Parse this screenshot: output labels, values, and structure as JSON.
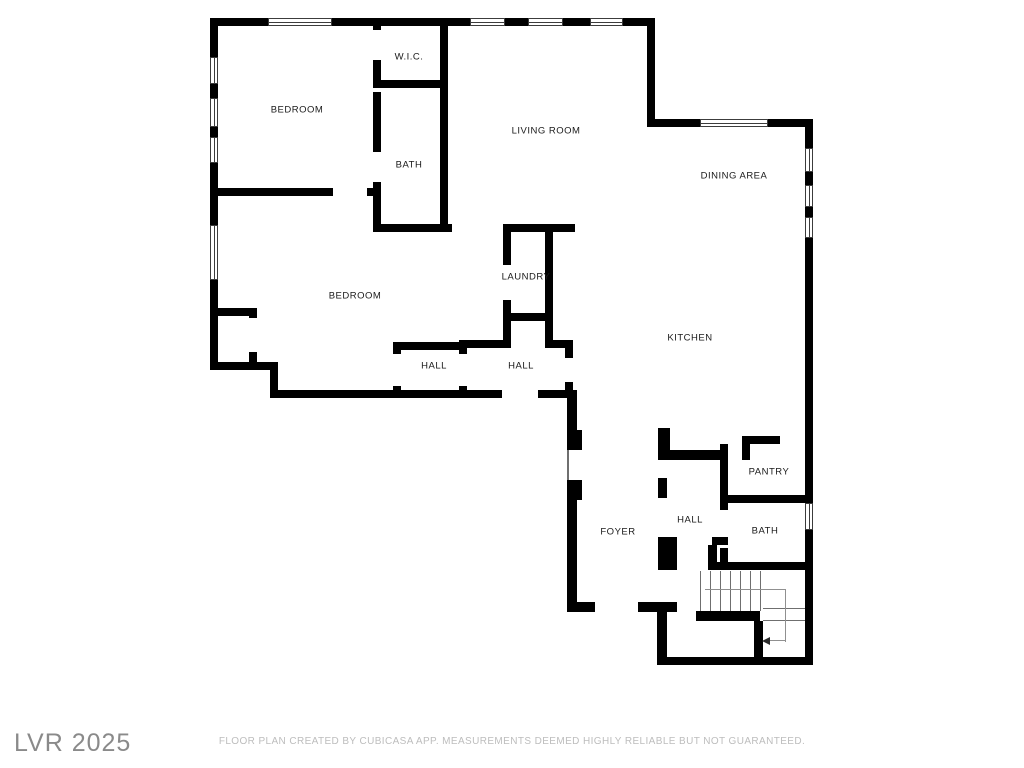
{
  "watermark": {
    "text": "LVR 2025",
    "color": "#8a8a8a"
  },
  "disclaimer": {
    "text": "FLOOR PLAN CREATED BY CUBICASA APP. MEASUREMENTS DEEMED HIGHLY RELIABLE BUT NOT GUARANTEED.",
    "color": "#bdbdbd"
  },
  "floorplan": {
    "wall_color": "#000000",
    "label_color": "#1a1a1a",
    "rooms": [
      {
        "id": "wic",
        "label": "W.I.C.",
        "x": 409,
        "y": 57
      },
      {
        "id": "bedroom-1",
        "label": "BEDROOM",
        "x": 297,
        "y": 110
      },
      {
        "id": "bath-upper",
        "label": "BATH",
        "x": 409,
        "y": 165
      },
      {
        "id": "living-room",
        "label": "LIVING ROOM",
        "x": 546,
        "y": 131
      },
      {
        "id": "dining-area",
        "label": "DINING AREA",
        "x": 734,
        "y": 176
      },
      {
        "id": "bedroom-2",
        "label": "BEDROOM",
        "x": 355,
        "y": 296
      },
      {
        "id": "laundry",
        "label": "LAUNDRY",
        "x": 526,
        "y": 277
      },
      {
        "id": "hall-1",
        "label": "HALL",
        "x": 434,
        "y": 366
      },
      {
        "id": "hall-2",
        "label": "HALL",
        "x": 521,
        "y": 366
      },
      {
        "id": "kitchen",
        "label": "KITCHEN",
        "x": 690,
        "y": 338
      },
      {
        "id": "pantry",
        "label": "PANTRY",
        "x": 769,
        "y": 472
      },
      {
        "id": "hall-3",
        "label": "HALL",
        "x": 690,
        "y": 520
      },
      {
        "id": "foyer",
        "label": "FOYER",
        "x": 618,
        "y": 532
      },
      {
        "id": "bath-lower",
        "label": "BATH",
        "x": 765,
        "y": 531
      }
    ],
    "walls": [
      [
        210,
        18,
        58,
        8
      ],
      [
        332,
        18,
        138,
        8
      ],
      [
        505,
        18,
        23,
        8
      ],
      [
        563,
        18,
        27,
        8
      ],
      [
        623,
        18,
        32,
        8
      ],
      [
        210,
        18,
        8,
        39
      ],
      [
        210,
        84,
        8,
        14
      ],
      [
        210,
        127,
        8,
        10
      ],
      [
        210,
        163,
        8,
        62
      ],
      [
        210,
        280,
        8,
        90
      ],
      [
        647,
        18,
        8,
        109
      ],
      [
        647,
        119,
        53,
        8
      ],
      [
        768,
        119,
        45,
        8
      ],
      [
        805,
        119,
        8,
        29
      ],
      [
        805,
        172,
        8,
        13
      ],
      [
        805,
        207,
        8,
        10
      ],
      [
        805,
        238,
        8,
        265
      ],
      [
        805,
        530,
        8,
        135
      ],
      [
        373,
        18,
        8,
        12
      ],
      [
        373,
        60,
        8,
        28
      ],
      [
        373,
        80,
        75,
        8
      ],
      [
        440,
        18,
        8,
        214
      ],
      [
        373,
        92,
        8,
        60
      ],
      [
        373,
        182,
        8,
        48
      ],
      [
        373,
        224,
        79,
        8
      ],
      [
        503,
        224,
        72,
        8
      ],
      [
        210,
        188,
        123,
        8
      ],
      [
        367,
        188,
        14,
        8
      ],
      [
        210,
        308,
        47,
        8
      ],
      [
        249,
        308,
        8,
        10
      ],
      [
        249,
        352,
        8,
        18
      ],
      [
        210,
        362,
        68,
        8
      ],
      [
        270,
        362,
        8,
        36
      ],
      [
        278,
        390,
        224,
        8
      ],
      [
        538,
        390,
        39,
        8
      ],
      [
        393,
        342,
        70,
        8
      ],
      [
        393,
        342,
        8,
        12
      ],
      [
        393,
        386,
        8,
        12
      ],
      [
        459,
        342,
        8,
        12
      ],
      [
        459,
        386,
        8,
        12
      ],
      [
        459,
        340,
        52,
        8
      ],
      [
        545,
        340,
        28,
        8
      ],
      [
        503,
        232,
        8,
        33
      ],
      [
        503,
        300,
        8,
        48
      ],
      [
        545,
        232,
        8,
        116
      ],
      [
        511,
        313,
        34,
        8
      ],
      [
        565,
        340,
        8,
        18
      ],
      [
        565,
        382,
        8,
        16
      ],
      [
        567,
        398,
        10,
        52
      ],
      [
        567,
        480,
        10,
        122
      ],
      [
        567,
        430,
        15,
        20
      ],
      [
        567,
        480,
        15,
        20
      ],
      [
        567,
        602,
        28,
        10
      ],
      [
        638,
        602,
        39,
        10
      ],
      [
        657,
        612,
        10,
        53
      ],
      [
        657,
        657,
        156,
        8
      ],
      [
        658,
        428,
        12,
        32
      ],
      [
        665,
        450,
        63,
        10
      ],
      [
        658,
        478,
        9,
        20
      ],
      [
        742,
        436,
        8,
        24
      ],
      [
        742,
        436,
        38,
        8
      ],
      [
        720,
        495,
        93,
        8
      ],
      [
        720,
        444,
        8,
        66
      ],
      [
        720,
        548,
        8,
        22
      ],
      [
        658,
        537,
        19,
        33
      ],
      [
        712,
        537,
        16,
        8
      ],
      [
        708,
        545,
        9,
        25
      ],
      [
        708,
        562,
        105,
        8
      ],
      [
        696,
        611,
        64,
        10
      ],
      [
        754,
        621,
        9,
        42
      ]
    ],
    "windows": [
      [
        268,
        18,
        64,
        8
      ],
      [
        470,
        18,
        35,
        8
      ],
      [
        528,
        18,
        35,
        8
      ],
      [
        590,
        18,
        33,
        8
      ],
      [
        700,
        119,
        68,
        8
      ],
      [
        210,
        57,
        8,
        27
      ],
      [
        210,
        98,
        8,
        29
      ],
      [
        210,
        137,
        8,
        26
      ],
      [
        210,
        225,
        8,
        55
      ],
      [
        805,
        148,
        8,
        24
      ],
      [
        805,
        185,
        8,
        22
      ],
      [
        805,
        217,
        8,
        21
      ],
      [
        805,
        503,
        8,
        27
      ]
    ],
    "thin_lines": [
      [
        567,
        450,
        2,
        30
      ],
      [
        700,
        571,
        1,
        40
      ],
      [
        710,
        571,
        1,
        40
      ],
      [
        720,
        571,
        1,
        40
      ],
      [
        730,
        571,
        1,
        40
      ],
      [
        740,
        571,
        1,
        40
      ],
      [
        750,
        571,
        1,
        40
      ],
      [
        760,
        571,
        1,
        40
      ],
      [
        763,
        608,
        42,
        1
      ],
      [
        763,
        620,
        42,
        1
      ]
    ],
    "guide_lines": [
      [
        705,
        589,
        81,
        1
      ],
      [
        785,
        589,
        1,
        53
      ],
      [
        770,
        640,
        16,
        1
      ]
    ],
    "stair_arrow": {
      "x": 762,
      "y": 637
    }
  }
}
